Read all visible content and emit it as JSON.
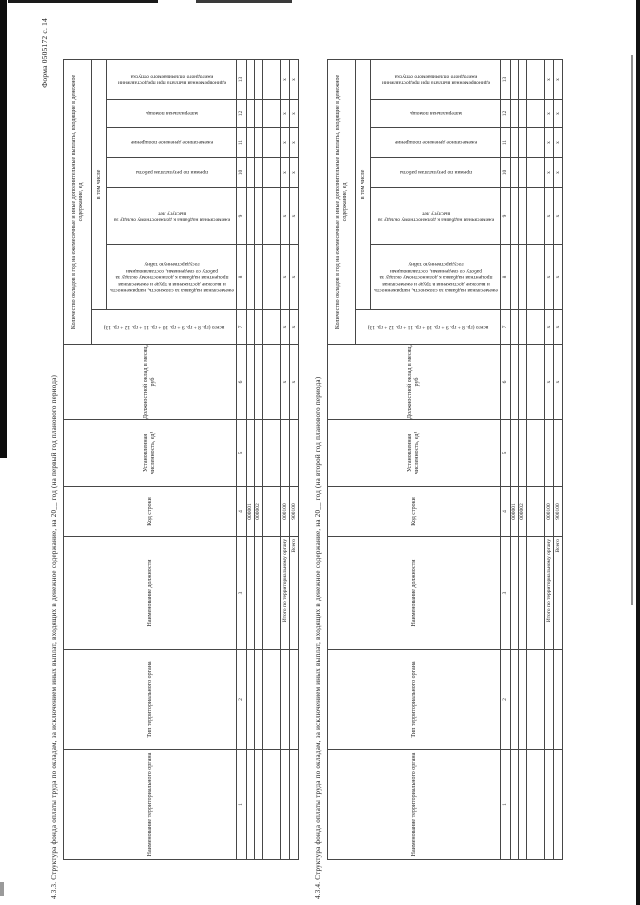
{
  "form_label": "Форма 0505172 с. 14",
  "table_template": {
    "group_headers": {
      "qty": "Количество окладов в год на ежемесячные и иные дополнительные выплаты, входящие в денежное содержание, ед",
      "including": "в том числе"
    },
    "columns": [
      {
        "num": "1",
        "label": "Наименование территориального органа"
      },
      {
        "num": "2",
        "label": "Тип территориального органа"
      },
      {
        "num": "3",
        "label": "Наименование должности"
      },
      {
        "num": "4",
        "label": "Код строки"
      },
      {
        "num": "5",
        "label": "Установленная численность, ед¹"
      },
      {
        "num": "6",
        "label": "Должностной оклад в месяц, руб"
      },
      {
        "num": "7",
        "label": "всего (гр. 8 + гр. 9 + гр. 10 + гр. 11 + гр. 12 + гр. 13)"
      },
      {
        "num": "8",
        "label": "ежемесячная надбавка за сложность, напряженность и высокие достижения в труде и ежемесячная процентная надбавка к должностному окладу за работу со сведениями, составляющими государственную тайну"
      },
      {
        "num": "9",
        "label": "ежемесячная надбавка к должностному окладу за выслугу лет"
      },
      {
        "num": "10",
        "label": "премии по результатам работы"
      },
      {
        "num": "11",
        "label": "ежемесячное денежное поощрение"
      },
      {
        "num": "12",
        "label": "материальная помощь"
      },
      {
        "num": "13",
        "label": "единовременная выплата при предоставлении ежегодного оплачиваемого отпуска"
      }
    ]
  },
  "sections": [
    {
      "id": "4.3.3",
      "title": "4.3.3. Структура фонда оплаты труда по окладам, за исключением иных выплат, входящих в денежное содержание, на 20__ год (на первый год планового периода)",
      "rows": [
        {
          "cells": [
            "",
            "",
            "",
            "000001",
            "",
            "",
            "",
            "",
            "",
            "",
            "",
            "",
            ""
          ]
        },
        {
          "cells": [
            "",
            "",
            "",
            "000002",
            "",
            "",
            "",
            "",
            "",
            "",
            "",
            "",
            ""
          ]
        },
        {
          "cells": [
            "",
            "",
            "",
            "",
            "",
            "",
            "",
            "",
            "",
            "",
            "",
            "",
            ""
          ]
        },
        {
          "cells": [
            "",
            "",
            "Итого по территориальному органу",
            "000100",
            "",
            "x",
            "x",
            "x",
            "x",
            "x",
            "x",
            "x",
            "x"
          ]
        },
        {
          "cells": [
            "",
            "",
            "Всего",
            "900100",
            "",
            "x",
            "x",
            "x",
            "x",
            "x",
            "x",
            "x",
            "x"
          ]
        }
      ]
    },
    {
      "id": "4.3.4",
      "title": "4.3.4. Структура фонда оплаты труда по окладам, за исключением иных выплат, входящих в денежное содержание, на 20__ год (на второй год планового периода)",
      "rows": [
        {
          "cells": [
            "",
            "",
            "",
            "000001",
            "",
            "",
            "",
            "",
            "",
            "",
            "",
            "",
            ""
          ]
        },
        {
          "cells": [
            "",
            "",
            "",
            "000002",
            "",
            "",
            "",
            "",
            "",
            "",
            "",
            "",
            ""
          ]
        },
        {
          "cells": [
            "",
            "",
            "",
            "",
            "",
            "",
            "",
            "",
            "",
            "",
            "",
            "",
            ""
          ]
        },
        {
          "cells": [
            "",
            "",
            "Итого по территориальному органу",
            "000100",
            "",
            "x",
            "x",
            "x",
            "x",
            "x",
            "x",
            "x",
            "x"
          ]
        },
        {
          "cells": [
            "",
            "",
            "Всего",
            "900100",
            "",
            "x",
            "x",
            "x",
            "x",
            "x",
            "x",
            "x",
            "x"
          ]
        }
      ]
    }
  ]
}
